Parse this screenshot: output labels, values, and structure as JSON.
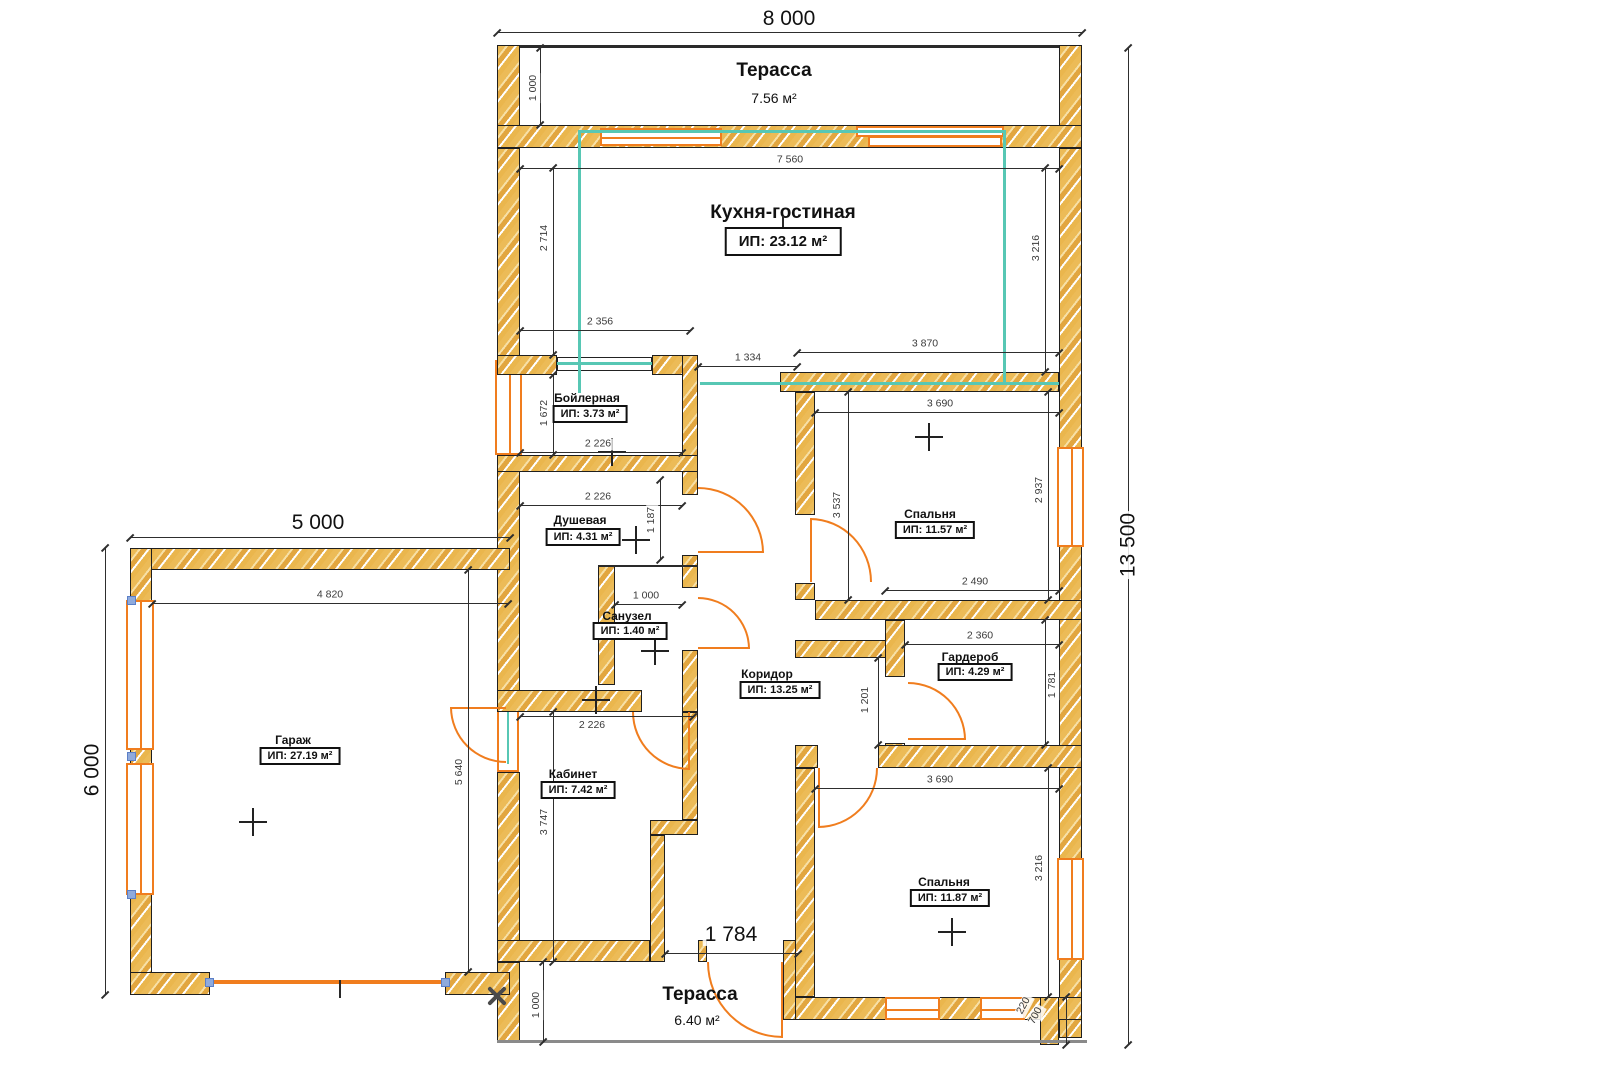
{
  "plan_title": "Floor plan",
  "rooms": {
    "terrace_top": {
      "name": "Терасса",
      "area": "7.56 м²"
    },
    "kitchen": {
      "name": "Кухня-гостиная",
      "area": "ИП:   23.12 м²"
    },
    "boiler": {
      "name": "Бойлерная",
      "area": "ИП: 3.73 м²"
    },
    "shower": {
      "name": "Душевая",
      "area": "ИП: 4.31 м²"
    },
    "wc": {
      "name": "Санузел",
      "area": "ИП: 1.40 м²"
    },
    "hall": {
      "name": "Коридор",
      "area": "ИП: 13.25 м²"
    },
    "bedroom1": {
      "name": "Спальня",
      "area": "ИП: 11.57 м²"
    },
    "wardrobe": {
      "name": "Гардероб",
      "area": "ИП: 4.29 м²"
    },
    "garage": {
      "name": "Гараж",
      "area": "ИП: 27.19 м²"
    },
    "office": {
      "name": "Кабинет",
      "area": "ИП: 7.42 м²"
    },
    "bedroom2": {
      "name": "Спальня",
      "area": "ИП: 11.87 м²"
    },
    "terrace_bottom": {
      "name": "Терасса",
      "area": "6.40 м²"
    }
  },
  "dims": {
    "overall_w": "8 000",
    "overall_h": "13 500",
    "garage_w": "5 000",
    "garage_h": "6 000",
    "terr1_h": "1 000",
    "kitchen_w": "7 560",
    "kitchen_hl": "2 714",
    "kitchen_hr": "3 216",
    "counter_w": "2 356",
    "opening_w": "1 334",
    "hall_w": "3 870",
    "boiler_h": "1 672",
    "boiler_w": "2 226",
    "shower_w": "2 226",
    "shower_h": "1 187",
    "wc_w": "1 000",
    "bed1_door": "3 537",
    "bed1_w": "3 690",
    "bed1_h": "2 937",
    "bed1_bw": "2 490",
    "ward_w": "2 360",
    "ward_h": "1 781",
    "hall_h": "1 201",
    "gar_iw": "4 820",
    "gar_ih": "5 640",
    "office_w": "2 226",
    "office_h": "3 747",
    "bed2_w": "3 690",
    "bed2_h": "3 216",
    "entry_w": "1 784",
    "terr2_h": "1 000",
    "step1": "220",
    "step2": "700"
  },
  "colors": {
    "wall": "#eab64d",
    "opening": "#f07d1e",
    "highlight": "#57c7b4"
  }
}
